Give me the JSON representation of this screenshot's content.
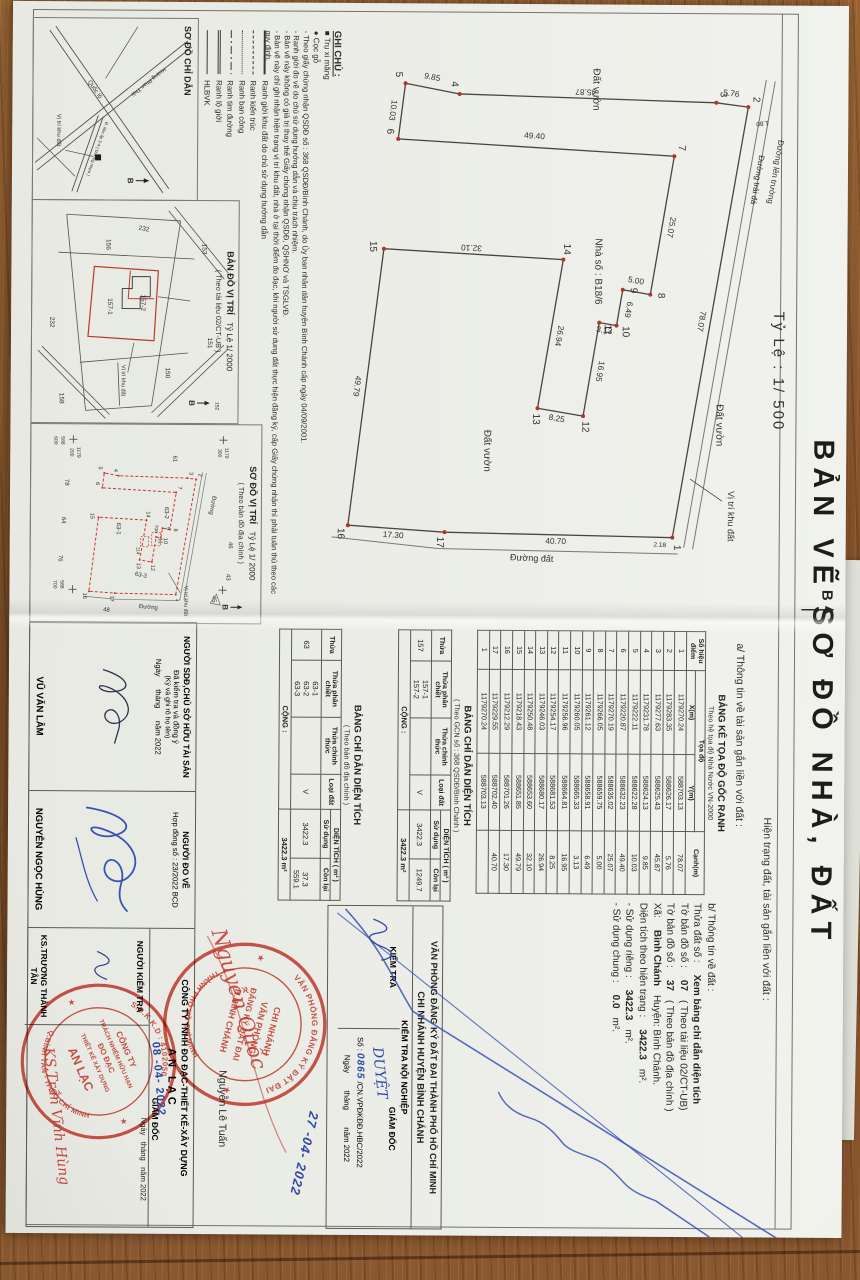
{
  "title": "BẢN VẼ SƠ ĐỒ NHÀ, ĐẤT",
  "header": {
    "hien_trang": "Hiện trạng đất, tài sản gắn liền với đất :",
    "section_a": "a/ Thông tin về tài sản gắn liền với đất :",
    "scale_label": "Tỷ Lệ : 1/ 500"
  },
  "main_map": {
    "north_label": "B",
    "labels": {
      "dat_vuon": "Đất vườn",
      "house": "Nhà số : B18/6",
      "duong_dat": "Đường đất",
      "road1": "Đường lên trường",
      "road2": "Đường trải đá",
      "site": "Vị trí khu đất",
      "tick1": "1.80",
      "tick2": "2.18"
    }
  },
  "coord_table": {
    "title": "BẢNG KÊ TỌA ĐỘ GỐC RANH",
    "subtitle": "Theo hệ tọa độ Nhà Nước VN-2000",
    "columns": {
      "point": "Số hiệu điểm",
      "group": "Tọa độ",
      "x": "X(m)",
      "y": "Y(m)",
      "edge": "Cạnh(m)"
    },
    "rows": [
      [
        "1",
        "1179270.24",
        "588703.13",
        "78.07"
      ],
      [
        "2",
        "1179283.35",
        "588626.17",
        "5.76"
      ],
      [
        "3",
        "1179277.63",
        "588625.43",
        "45.87"
      ],
      [
        "4",
        "1179231.78",
        "588624.13",
        "9.85"
      ],
      [
        "5",
        "1179222.11",
        "588622.28",
        "10.03"
      ],
      [
        "6",
        "1179220.87",
        "588632.23",
        "49.40"
      ],
      [
        "7",
        "1179270.19",
        "588635.02",
        "25.07"
      ],
      [
        "8",
        "1179266.05",
        "588659.75",
        "5.00"
      ],
      [
        "9",
        "1179261.12",
        "588658.91",
        "6.49"
      ],
      [
        "10",
        "1179260.05",
        "588665.33",
        "3.13"
      ],
      [
        "11",
        "1179256.96",
        "588664.81",
        "16.95"
      ],
      [
        "12",
        "1179254.17",
        "588681.53",
        "8.25"
      ],
      [
        "13",
        "1179246.03",
        "588680.17",
        "26.94"
      ],
      [
        "14",
        "1179250.48",
        "588653.60",
        "32.10"
      ],
      [
        "15",
        "1179218.43",
        "588651.85",
        "49.79"
      ],
      [
        "16",
        "1179212.29",
        "588701.26",
        "17.30"
      ],
      [
        "17",
        "1179229.55",
        "588702.40",
        "40.70"
      ],
      [
        "1",
        "1179270.24",
        "588703.13",
        ""
      ]
    ]
  },
  "area_table_1": {
    "title": "BẢNG CHỈ DẪN DIỆN TÍCH",
    "subtitle": "( Theo GCN số : 368 QSDĐ/Bình Chánh )",
    "col_thua": "Thửa",
    "col_phan_chiet": "Thửa phân chiết",
    "col_chinh_thuc": "Thửa chính thức",
    "col_loai": "Loại đất",
    "col_dientich": "DIỆN TÍCH ( m² )",
    "col_su_dung": "Sử dụng",
    "col_con_lai": "Còn lại",
    "thua": "157",
    "phan_chiet": [
      "157-1",
      "157-2"
    ],
    "chinh_thuc": "",
    "loai": "V",
    "su_dung": "3422.3",
    "con_lai": [
      "1249.7"
    ],
    "cong_label": "CỘNG :",
    "cong_value": "3422.3 m²"
  },
  "area_table_2": {
    "title": "BẢNG CHỈ DẪN DIỆN TÍCH",
    "subtitle": "( Theo bản đồ địa chính )",
    "col_thua": "Thửa",
    "col_phan_chiet": "Thửa phân chiết",
    "col_chinh_thuc": "Thửa chính thức",
    "col_loai": "Loại đất",
    "col_dientich": "DIỆN TÍCH ( m² )",
    "col_su_dung": "Sử dụng",
    "col_con_lai": "Còn lại",
    "thua": "63",
    "phan_chiet": [
      "63-1",
      "63-2",
      "63-3"
    ],
    "chinh_thuc": "",
    "loai": "V",
    "su_dung": "3422.3",
    "con_lai": [
      "",
      "37.3",
      "559.1"
    ],
    "cong_label": "CỘNG :",
    "cong_value": "3422.3 m²"
  },
  "section_b": {
    "heading": "b/ Thông tin về đất :",
    "rows": [
      {
        "k": "Thửa đất số :",
        "v": "Xem bảng chỉ dẫn diện tích",
        "n": ""
      },
      {
        "k": "Tờ bản đồ số :",
        "v": "07",
        "n": "( Theo tài liệu 02/CT-UB)"
      },
      {
        "k": "Tờ bản đồ số :",
        "v": "37",
        "n": "( Theo bản đồ địa chính )"
      },
      {
        "k": "Xã:",
        "v": "Bình Chánh",
        "n": "Huyện: Bình Chánh."
      },
      {
        "k": "Diện tích theo hiện trạng :",
        "v": "3422.3",
        "n": "m²."
      },
      {
        "k": "- Sử dụng riêng :",
        "v": "3422.3",
        "n": "m²."
      },
      {
        "k": "- Sử dụng chung :",
        "v": "0.0",
        "n": "m²."
      }
    ]
  },
  "ghi_chu": {
    "heading": "GHI CHÚ :",
    "symbols": [
      {
        "glyph": "■",
        "label": "Trụ xi măng"
      },
      {
        "glyph": "●",
        "label": "Cọc gỗ"
      }
    ],
    "notes": [
      "- Theo giấy chứng nhận QSDĐ số : 368 QSDĐ/Bình Chánh, do Ủy ban nhân dân huyện Bình Chánh cấp ngày 04/09/2001.",
      "- Ranh giới đo vẽ do chủ sử dụng hướng dẫn và chịu trách nhiệm.",
      "- Bản vẽ này không có giá trị thay thế Giấy chứng nhận QSDĐ, QSHNƠ và TSGLVĐ.",
      "- Bản vẽ này chỉ ghi nhận hiện trạng vị trí khu đất, nhà ở tại thời điểm đo đạc, khi người sử dụng đất thực hiện đăng ký, cấp Giấy chứng nhận thì phải tuân thủ theo các quy định."
    ]
  },
  "legend": [
    {
      "style": "thick",
      "label": "Ranh giới khu đất do chủ sử dụng hướng dẫn"
    },
    {
      "style": "dashed",
      "label": "Ranh kiến trúc"
    },
    {
      "style": "dotted",
      "label": "Ranh ban công"
    },
    {
      "style": "dashdot",
      "label": "Ranh tim đường"
    },
    {
      "style": "double",
      "label": "Ranh lộ giới"
    },
    {
      "style": "solid",
      "label": "HLBVK"
    }
  ],
  "inset_chi_dan": {
    "title": "SƠ ĐỒ CHỈ DẪN",
    "north_label": "B",
    "site": "Vị trí khu đất",
    "roads": [
      "Quốc lộ",
      "Hoàng Phan Thái",
      "Đ. liên ấp 3-4 ( Đường nhựa )"
    ]
  },
  "inset_ban_do": {
    "title": "BẢN ĐỒ VỊ TRÍ",
    "scale": "Tỷ Lệ 1/ 2000",
    "source": "( Theo tài liệu 02/CT-UB )",
    "north_label": "B",
    "site": "Vị trí khu đất",
    "parcels": [
      "153",
      "151",
      "152",
      "232",
      "156",
      "157-2",
      "157-1",
      "150",
      "232",
      "158"
    ]
  },
  "inset_so_do": {
    "title": "SƠ ĐỒ VỊ TRÍ",
    "scale": "Tỷ Lệ 1/ 2000",
    "source": "( Theo bản đồ địa chính )",
    "north_label": "B",
    "site": "Vị trí khu đất",
    "roads": [
      "Đường",
      "Đường"
    ],
    "parcels": [
      "61",
      "78",
      "64",
      "76",
      "43",
      "45",
      "46",
      "48",
      "63-1",
      "63-2",
      "63-3",
      "706",
      "114"
    ],
    "grid_labels": [
      [
        "1179",
        "300"
      ],
      [
        "1179",
        "200"
      ],
      [
        "588",
        "600"
      ],
      [
        "588",
        "700"
      ]
    ]
  },
  "office": {
    "line1": "VĂN PHÒNG ĐĂNG KÝ ĐẤT ĐAI THÀNH PHỐ HỒ CHÍ MINH",
    "line2": "CHI NHÁNH HUYỆN BÌNH CHÁNH",
    "noi_nghiep": "KIỂM TRA NỘI NGHIỆP",
    "kiem_tra": "KIỂM TRA",
    "giam_doc": "GIÁM ĐỐC",
    "duyet": "DUYỆT",
    "so_label": "Số :",
    "so_value": "0865",
    "so_suffix": "/CN.VPĐKĐĐ.HBC/2022",
    "ngay_line": "Ngày        tháng        năm 2022",
    "approver_name": "Nguyễn Lê Tuấn",
    "approve_date": "27 -04- 2022",
    "red_signature": "Nguyễn Quốc"
  },
  "stamps": {
    "vp": {
      "ring_top": "VĂN PHÒNG ĐĂNG KÝ ĐẤT ĐAI",
      "ring_bottom": "THÀNH PHỐ HỒ CHÍ MINH",
      "center": [
        "CHI NHÁNH",
        "VĂN PHÒNG",
        "ĐĂNG KÝ ĐẤT ĐAI",
        "H.BÌNH CHÁNH"
      ]
    },
    "an_lac": {
      "ring_top": "S.Đ.K.K.D : 4102050",
      "ring_bottom": "Q.BÌNH TÂN - TP.HỒ CHÍ MINH",
      "center": [
        "CÔNG TY",
        "TRÁCH NHIỆM HỮU HẠN",
        "ĐO ĐẠC",
        "THIẾT KẾ XÂY DỰNG",
        "AN LẠC"
      ]
    }
  },
  "signatures": {
    "cell1": {
      "title": "NGƯỜI SDĐ,CHỦ SỞ HỮU TÀI SẢN",
      "sub1": "Đã kiểm tra và đồng ý",
      "sub2": "(Ký và ghi rõ họ tên)",
      "date_line": "Ngày      tháng      năm 2022",
      "name": "VŨ VĂN LÂM"
    },
    "cell2": {
      "title": "NGƯỜI ĐO VẼ",
      "contract": "Hợp đồng số : 23/2022 BCD",
      "name": "NGUYỄN NGỌC HÙNG"
    },
    "company": {
      "line1": "CÔNG TY TNHH ĐO ĐẠC-THIẾT KẾ-XÂY DỰNG",
      "line2": "AN LẠC"
    },
    "cell3": {
      "title": "NGƯỜI KIỂM TRA",
      "name": "KS.TRƯƠNG THÀNH TÂN"
    },
    "cell4": {
      "giam_doc": "GIÁM ĐỐC",
      "date_stamp": "08 -04- 2022",
      "ngay_line": "Ngày   tháng   năm 2022",
      "red_signature": "KS.Trần Vĩnh Hùng"
    }
  }
}
